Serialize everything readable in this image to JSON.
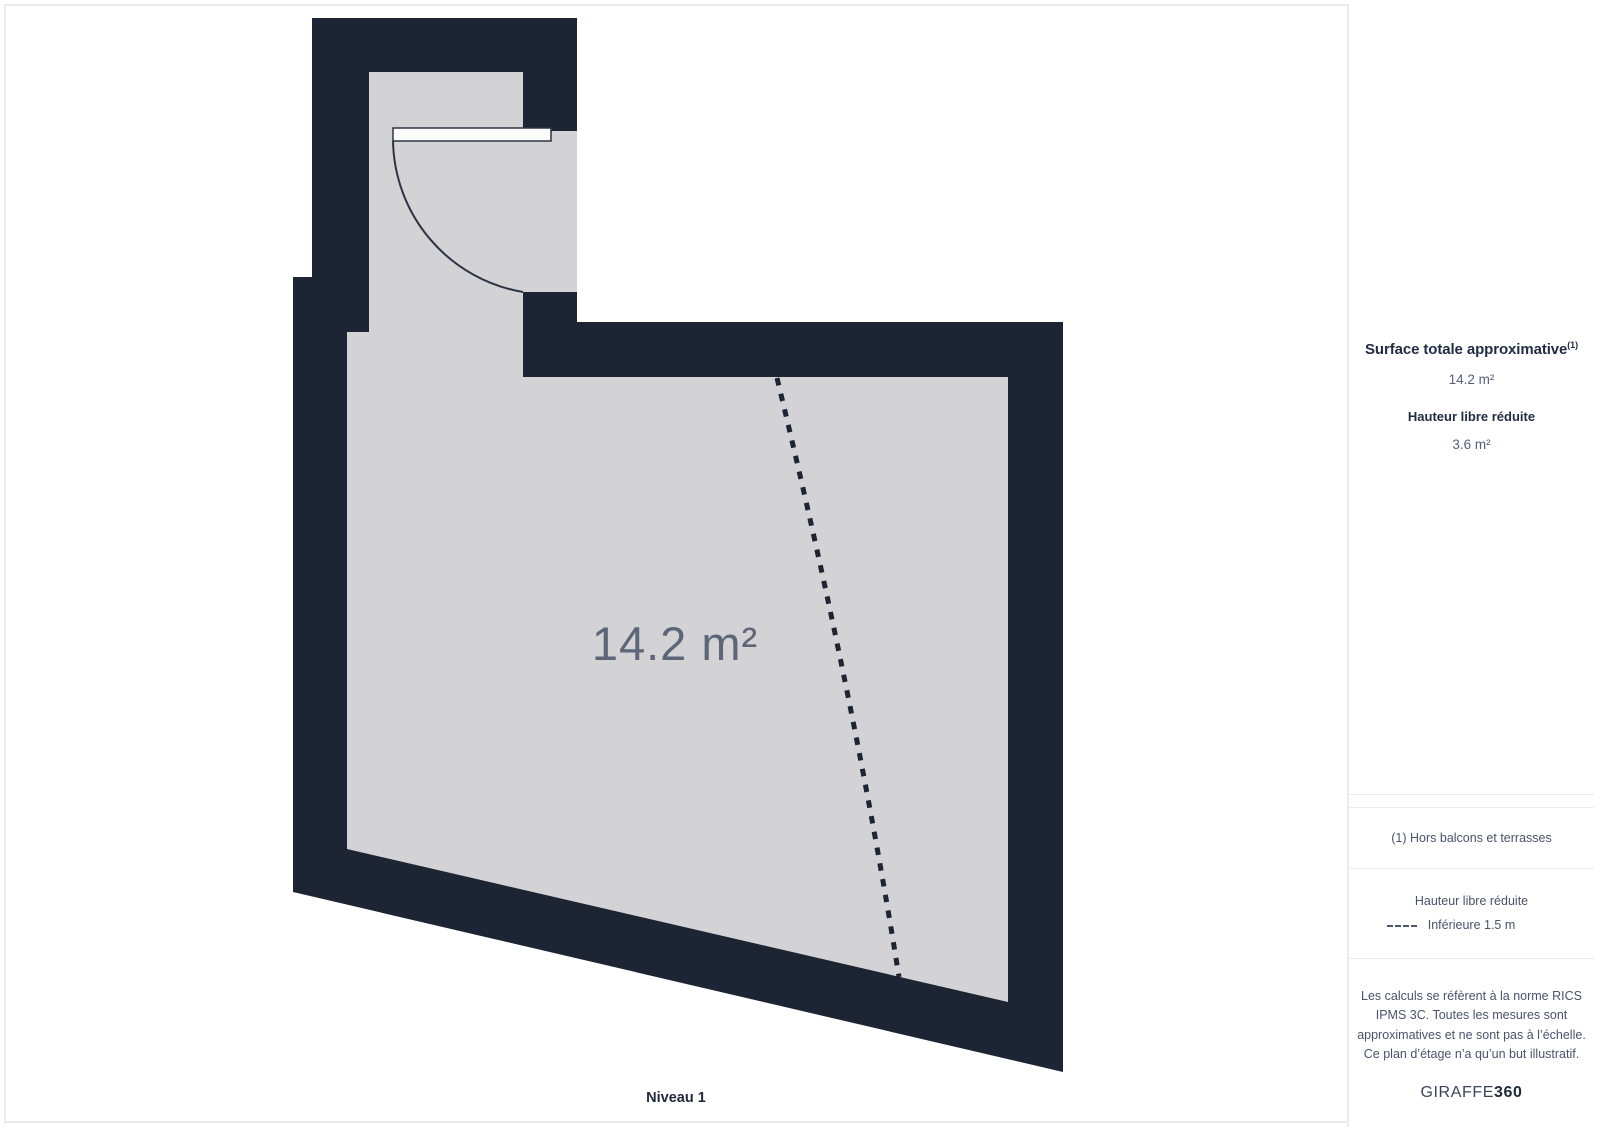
{
  "plan": {
    "room_area_label": "14.2 m²",
    "level_label": "Niveau 1",
    "colors": {
      "wall": "#1d2534",
      "floor": "#d3d3d5",
      "door_outline": "#2a3446",
      "room_label_text": "#5c6678"
    }
  },
  "sidebar": {
    "title": "Surface totale approximative",
    "title_sup": "(1)",
    "total_area_value": "14.2 m²",
    "reduced_height_label": "Hauteur libre réduite",
    "reduced_height_value": "3.6 m²",
    "note": "(1) Hors balcons et terrasses",
    "legend": {
      "label": "Hauteur libre réduite",
      "item": "Inférieure 1.5 m"
    },
    "disclaimer": "Les calculs se réfèrent à la norme RICS IPMS 3C. Toutes les mesures sont approximatives et ne sont pas à l’échelle. Ce plan d’étage n’a qu’un but illustratif.",
    "brand": {
      "name": "GIRAFFE",
      "suffix": "360"
    }
  }
}
